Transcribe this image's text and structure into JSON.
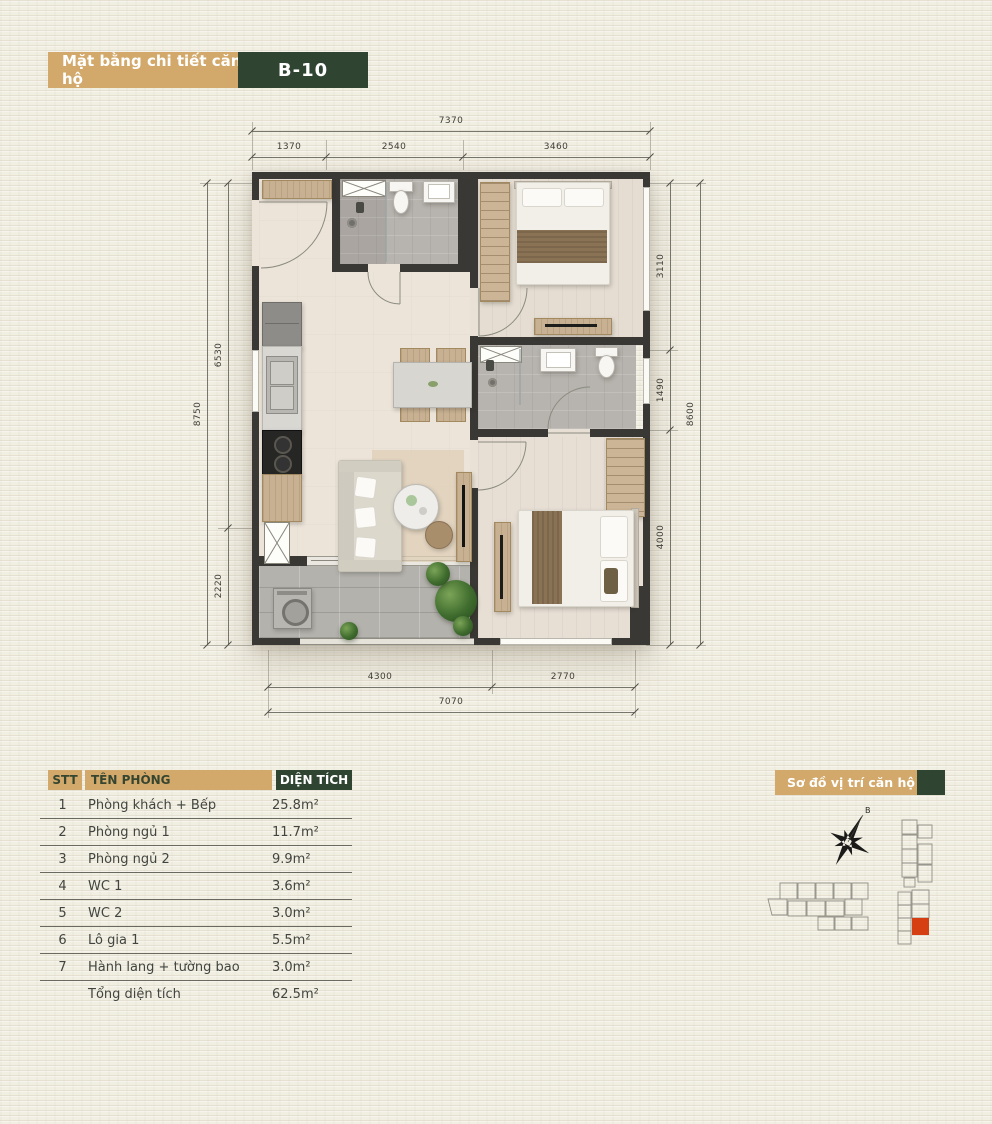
{
  "header": {
    "title": "Mặt bằng chi tiết căn hộ",
    "unit": "B-10"
  },
  "plan": {
    "dims": {
      "top": {
        "overall": "7370",
        "segments": [
          "1370",
          "2540",
          "3460"
        ]
      },
      "bottom": {
        "overall": "7070",
        "segments": [
          "4300",
          "2770"
        ]
      },
      "left": {
        "overall": "8750",
        "segments": [
          "6530",
          "2220"
        ]
      },
      "right": {
        "overall": "8600",
        "segments": [
          "3110",
          "1490",
          "4000"
        ]
      }
    }
  },
  "table": {
    "headers": {
      "stt": "STT",
      "name": "TÊN PHÒNG",
      "area": "DIỆN TÍCH"
    },
    "rows": [
      {
        "stt": "1",
        "name": "Phòng khách + Bếp",
        "area": "25.8m²"
      },
      {
        "stt": "2",
        "name": "Phòng ngủ 1",
        "area": "11.7m²"
      },
      {
        "stt": "3",
        "name": "Phòng ngủ 2",
        "area": "9.9m²"
      },
      {
        "stt": "4",
        "name": "WC 1",
        "area": "3.6m²"
      },
      {
        "stt": "5",
        "name": "WC 2",
        "area": "3.0m²"
      },
      {
        "stt": "6",
        "name": "Lô gia 1",
        "area": "5.5m²"
      },
      {
        "stt": "7",
        "name": "Hành lang + tường bao",
        "area": "3.0m²"
      }
    ],
    "total": {
      "name": "Tổng diện tích",
      "area": "62.5m²"
    }
  },
  "location": {
    "title": "Sơ đồ vị trí căn hộ",
    "compass": "B"
  },
  "colors": {
    "tan": "#d2a96b",
    "green": "#2f4531",
    "red": "#d63f12",
    "wall": "#3a3834"
  }
}
